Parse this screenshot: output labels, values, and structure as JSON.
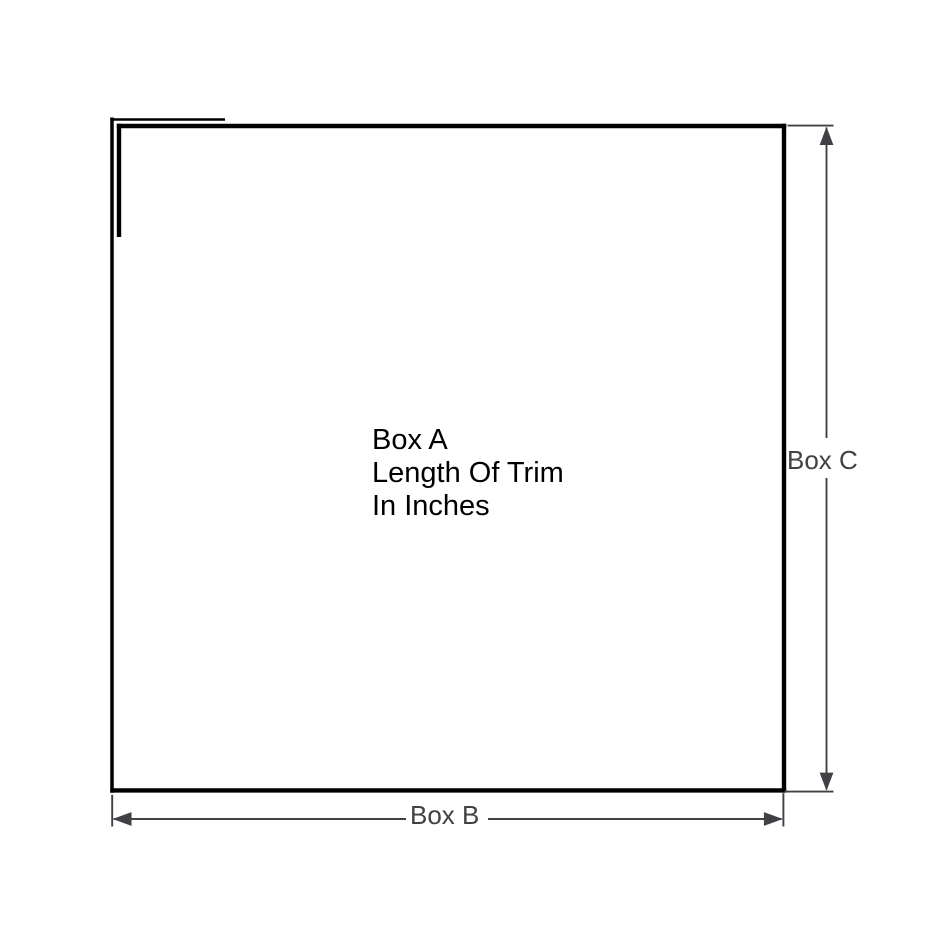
{
  "diagram": {
    "background_color": "#ffffff",
    "outline_color": "#000000",
    "dimension_color": "#3f4145",
    "center_label": {
      "line1": "Box A",
      "line2": "Length Of Trim",
      "line3": "In Inches"
    },
    "width_label": "Box B",
    "height_label": "Box C"
  }
}
